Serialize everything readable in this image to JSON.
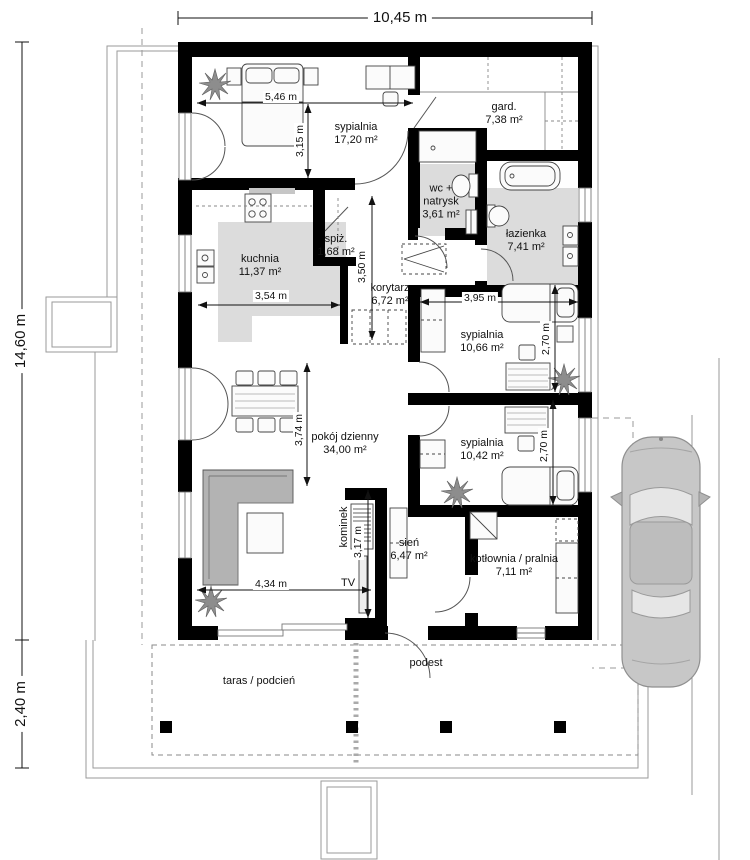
{
  "colors": {
    "wall": "#000000",
    "room_floor_gray": "#dcdcdc",
    "furniture_gray": "#b3b3b3",
    "outline_gray": "#999999"
  },
  "overall_dims": {
    "width": "10,45 m",
    "height": "14,60 m",
    "terrace_depth": "2,40 m"
  },
  "rooms": [
    {
      "name": "sypialnia",
      "area": "17,20 m²"
    },
    {
      "name": "gard.",
      "area": "7,38 m²"
    },
    {
      "name": "wc + natrysk",
      "area": "3,61 m²"
    },
    {
      "name": "łazienka",
      "area": "7,41 m²"
    },
    {
      "name": "kuchnia",
      "area": "11,37 m²"
    },
    {
      "name": "spiż.",
      "area": "1,68 m²"
    },
    {
      "name": "korytarz",
      "area": "6,72 m²"
    },
    {
      "name": "sypialnia",
      "area": "10,66 m²"
    },
    {
      "name": "sypialnia",
      "area": "10,42 m²"
    },
    {
      "name": "pokój dzienny",
      "area": "34,00 m²"
    },
    {
      "name": "sień",
      "area": "6,47 m²"
    },
    {
      "name": "kotłownia / pralnia",
      "area": "7,11 m²"
    }
  ],
  "outdoor": {
    "terrace": "taras / podcień",
    "landing": "podest"
  },
  "fixtures": {
    "fireplace": "kominek",
    "tv": "TV"
  },
  "measurements": [
    "5,46 m",
    "3,15 m",
    "3,54 m",
    "3,50 m",
    "3,95 m",
    "2,70 m",
    "2,70 m",
    "3,74 m",
    "3,17 m",
    "4,34 m"
  ]
}
